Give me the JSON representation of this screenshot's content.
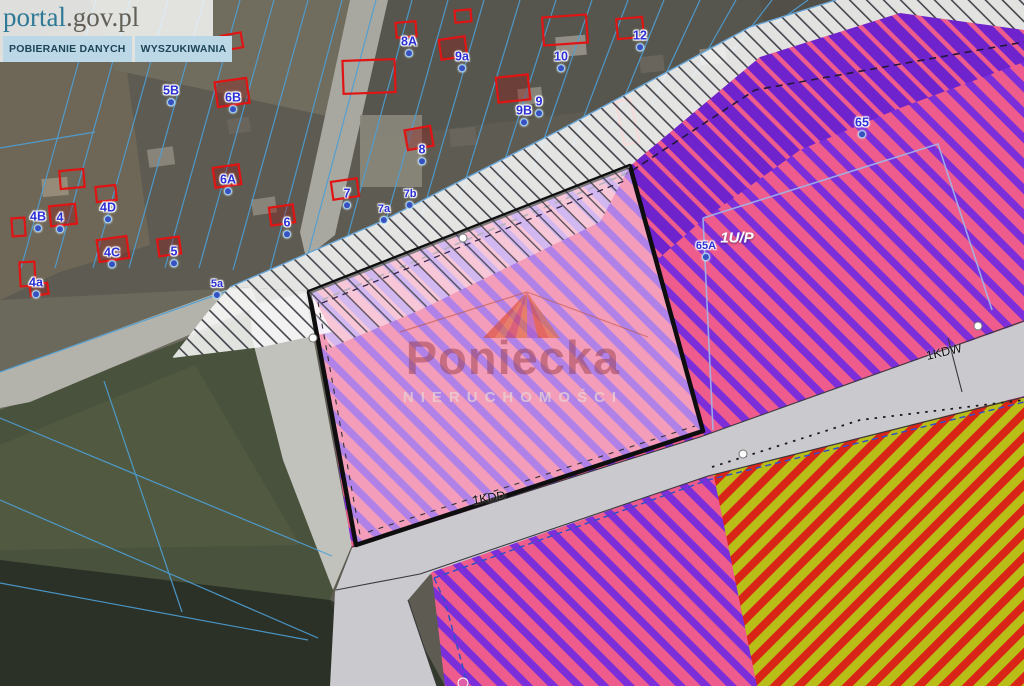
{
  "header": {
    "logo_prefix": "portal",
    "logo_suffix": ".gov.pl",
    "tabs": [
      {
        "label": "POBIERANIE DANYCH"
      },
      {
        "label": "WYSZUKIWANIA"
      }
    ]
  },
  "watermark": {
    "brand": "Poniecka",
    "subtitle": "NIERUCHOMOŚCI"
  },
  "map": {
    "parcel_labels": [
      {
        "text": "4B",
        "x": 38,
        "y": 221
      },
      {
        "text": "4",
        "x": 60,
        "y": 222
      },
      {
        "text": "4D",
        "x": 108,
        "y": 212
      },
      {
        "text": "4C",
        "x": 112,
        "y": 257
      },
      {
        "text": "4a",
        "x": 36,
        "y": 287
      },
      {
        "text": "5",
        "x": 174,
        "y": 256
      },
      {
        "text": "5a",
        "x": 217,
        "y": 289,
        "small": true
      },
      {
        "text": "5B",
        "x": 171,
        "y": 95
      },
      {
        "text": "6B",
        "x": 233,
        "y": 102
      },
      {
        "text": "6A",
        "x": 228,
        "y": 184
      },
      {
        "text": "6",
        "x": 287,
        "y": 227
      },
      {
        "text": "7",
        "x": 347,
        "y": 198
      },
      {
        "text": "7a",
        "x": 384,
        "y": 214,
        "small": true
      },
      {
        "text": "7b",
        "x": 410,
        "y": 199,
        "small": true
      },
      {
        "text": "8",
        "x": 422,
        "y": 154
      },
      {
        "text": "8A",
        "x": 409,
        "y": 46
      },
      {
        "text": "9a",
        "x": 462,
        "y": 61
      },
      {
        "text": "9B",
        "x": 524,
        "y": 115
      },
      {
        "text": "9",
        "x": 539,
        "y": 106
      },
      {
        "text": "10",
        "x": 561,
        "y": 61
      },
      {
        "text": "12",
        "x": 640,
        "y": 40
      },
      {
        "text": "65",
        "x": 862,
        "y": 127
      },
      {
        "text": "65A",
        "x": 706,
        "y": 251,
        "small": true
      }
    ],
    "zone_labels": [
      {
        "text": "1U/P",
        "x": 737,
        "y": 238
      }
    ],
    "road_labels": [
      {
        "text": "1KDW",
        "x": 944,
        "y": 352,
        "rot": -13
      },
      {
        "text": "1KDD",
        "x": 489,
        "y": 498,
        "rot": -9
      }
    ],
    "colors": {
      "zone_pink": "#ed5c8d",
      "zone_purple": "#7c2fd8",
      "zone_red": "#d92418",
      "zone_yellow": "#b9bd17",
      "road_gray": "#c9c9ce",
      "parcel_outline": "#0e0e0e",
      "cadastral_blue": "#4d9fd6",
      "building_red": "#e11414",
      "label_blue": "#2b2fd4"
    }
  }
}
